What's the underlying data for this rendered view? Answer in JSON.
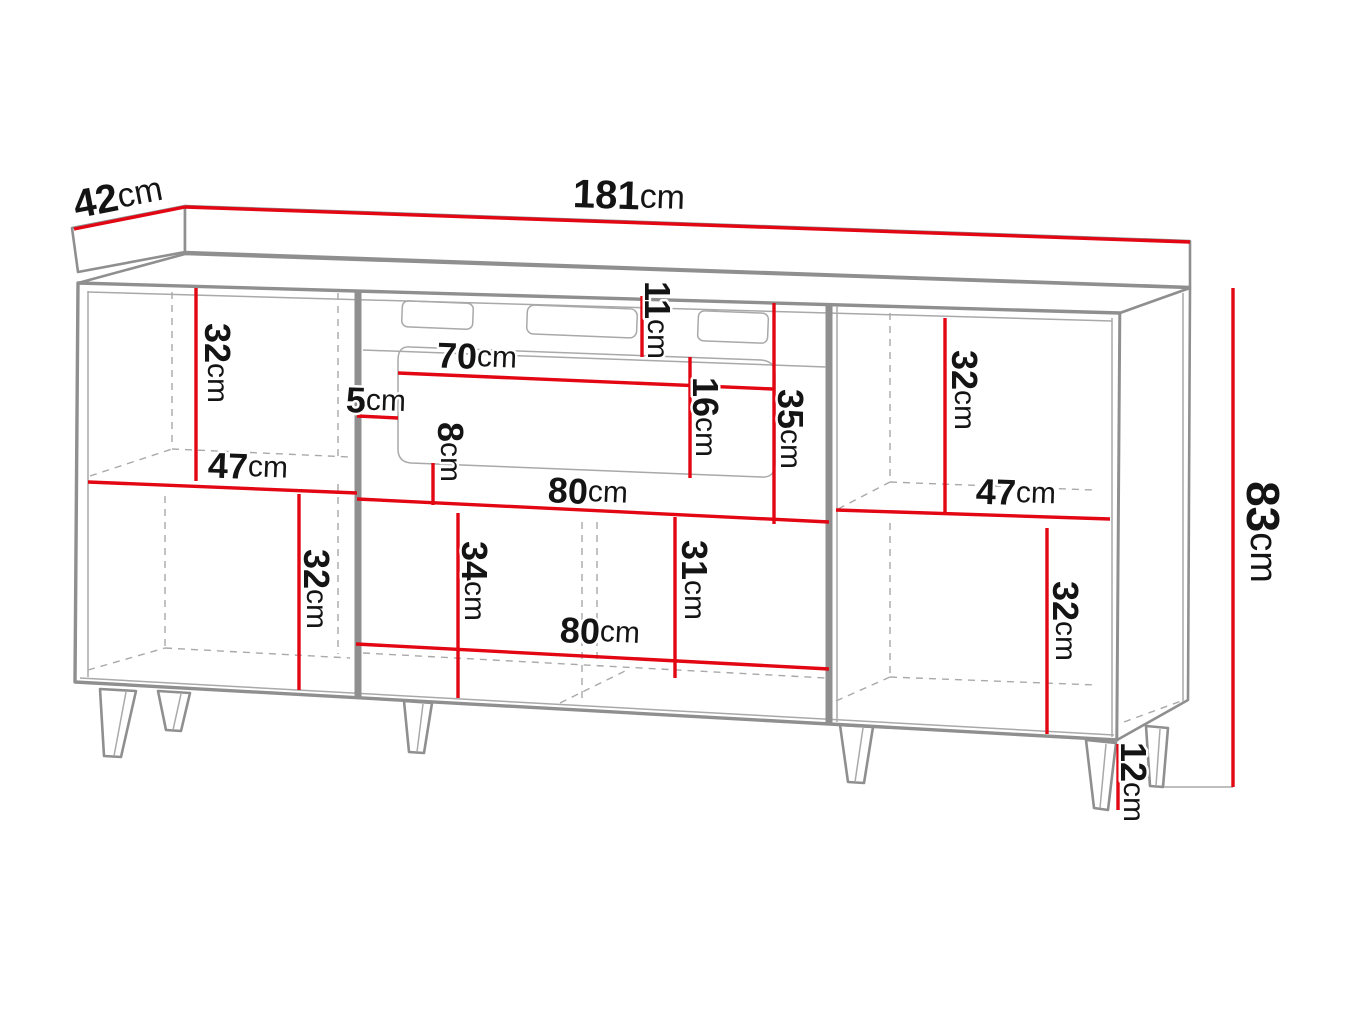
{
  "title": "Sideboard with fireplace insert — dimension diagram",
  "unit": "cm",
  "colors": {
    "dimension": "#e30613",
    "outline": "#8f8f8f",
    "outline-light": "#a9a9a9",
    "label": "#141414",
    "background": "#ffffff"
  },
  "dimensions": {
    "depth": {
      "value": "42",
      "unit": "cm"
    },
    "width": {
      "value": "181",
      "unit": "cm"
    },
    "height": {
      "value": "83",
      "unit": "cm"
    },
    "leg_height": {
      "value": "12",
      "unit": "cm"
    },
    "upper_left_compartment_height": {
      "value": "32",
      "unit": "cm"
    },
    "left_compartment_width": {
      "value": "47",
      "unit": "cm"
    },
    "lower_left_compartment_height": {
      "value": "32",
      "unit": "cm"
    },
    "fireplace_side_gap": {
      "value": "5",
      "unit": "cm"
    },
    "fireplace_top_gap": {
      "value": "11",
      "unit": "cm"
    },
    "fireplace_opening_width": {
      "value": "70",
      "unit": "cm"
    },
    "fireplace_bottom_gap": {
      "value": "8",
      "unit": "cm"
    },
    "fireplace_panel_width": {
      "value": "80",
      "unit": "cm"
    },
    "fireplace_insert_height": {
      "value": "16",
      "unit": "cm"
    },
    "fireplace_panel_height": {
      "value": "35",
      "unit": "cm"
    },
    "upper_right_compartment_height": {
      "value": "32",
      "unit": "cm"
    },
    "right_compartment_width": {
      "value": "47",
      "unit": "cm"
    },
    "middle_drawer_height": {
      "value": "34",
      "unit": "cm"
    },
    "middle_drawer_width": {
      "value": "80",
      "unit": "cm"
    },
    "middle_right_drawer_height": {
      "value": "31",
      "unit": "cm"
    },
    "lower_right_compartment_height": {
      "value": "32",
      "unit": "cm"
    }
  }
}
